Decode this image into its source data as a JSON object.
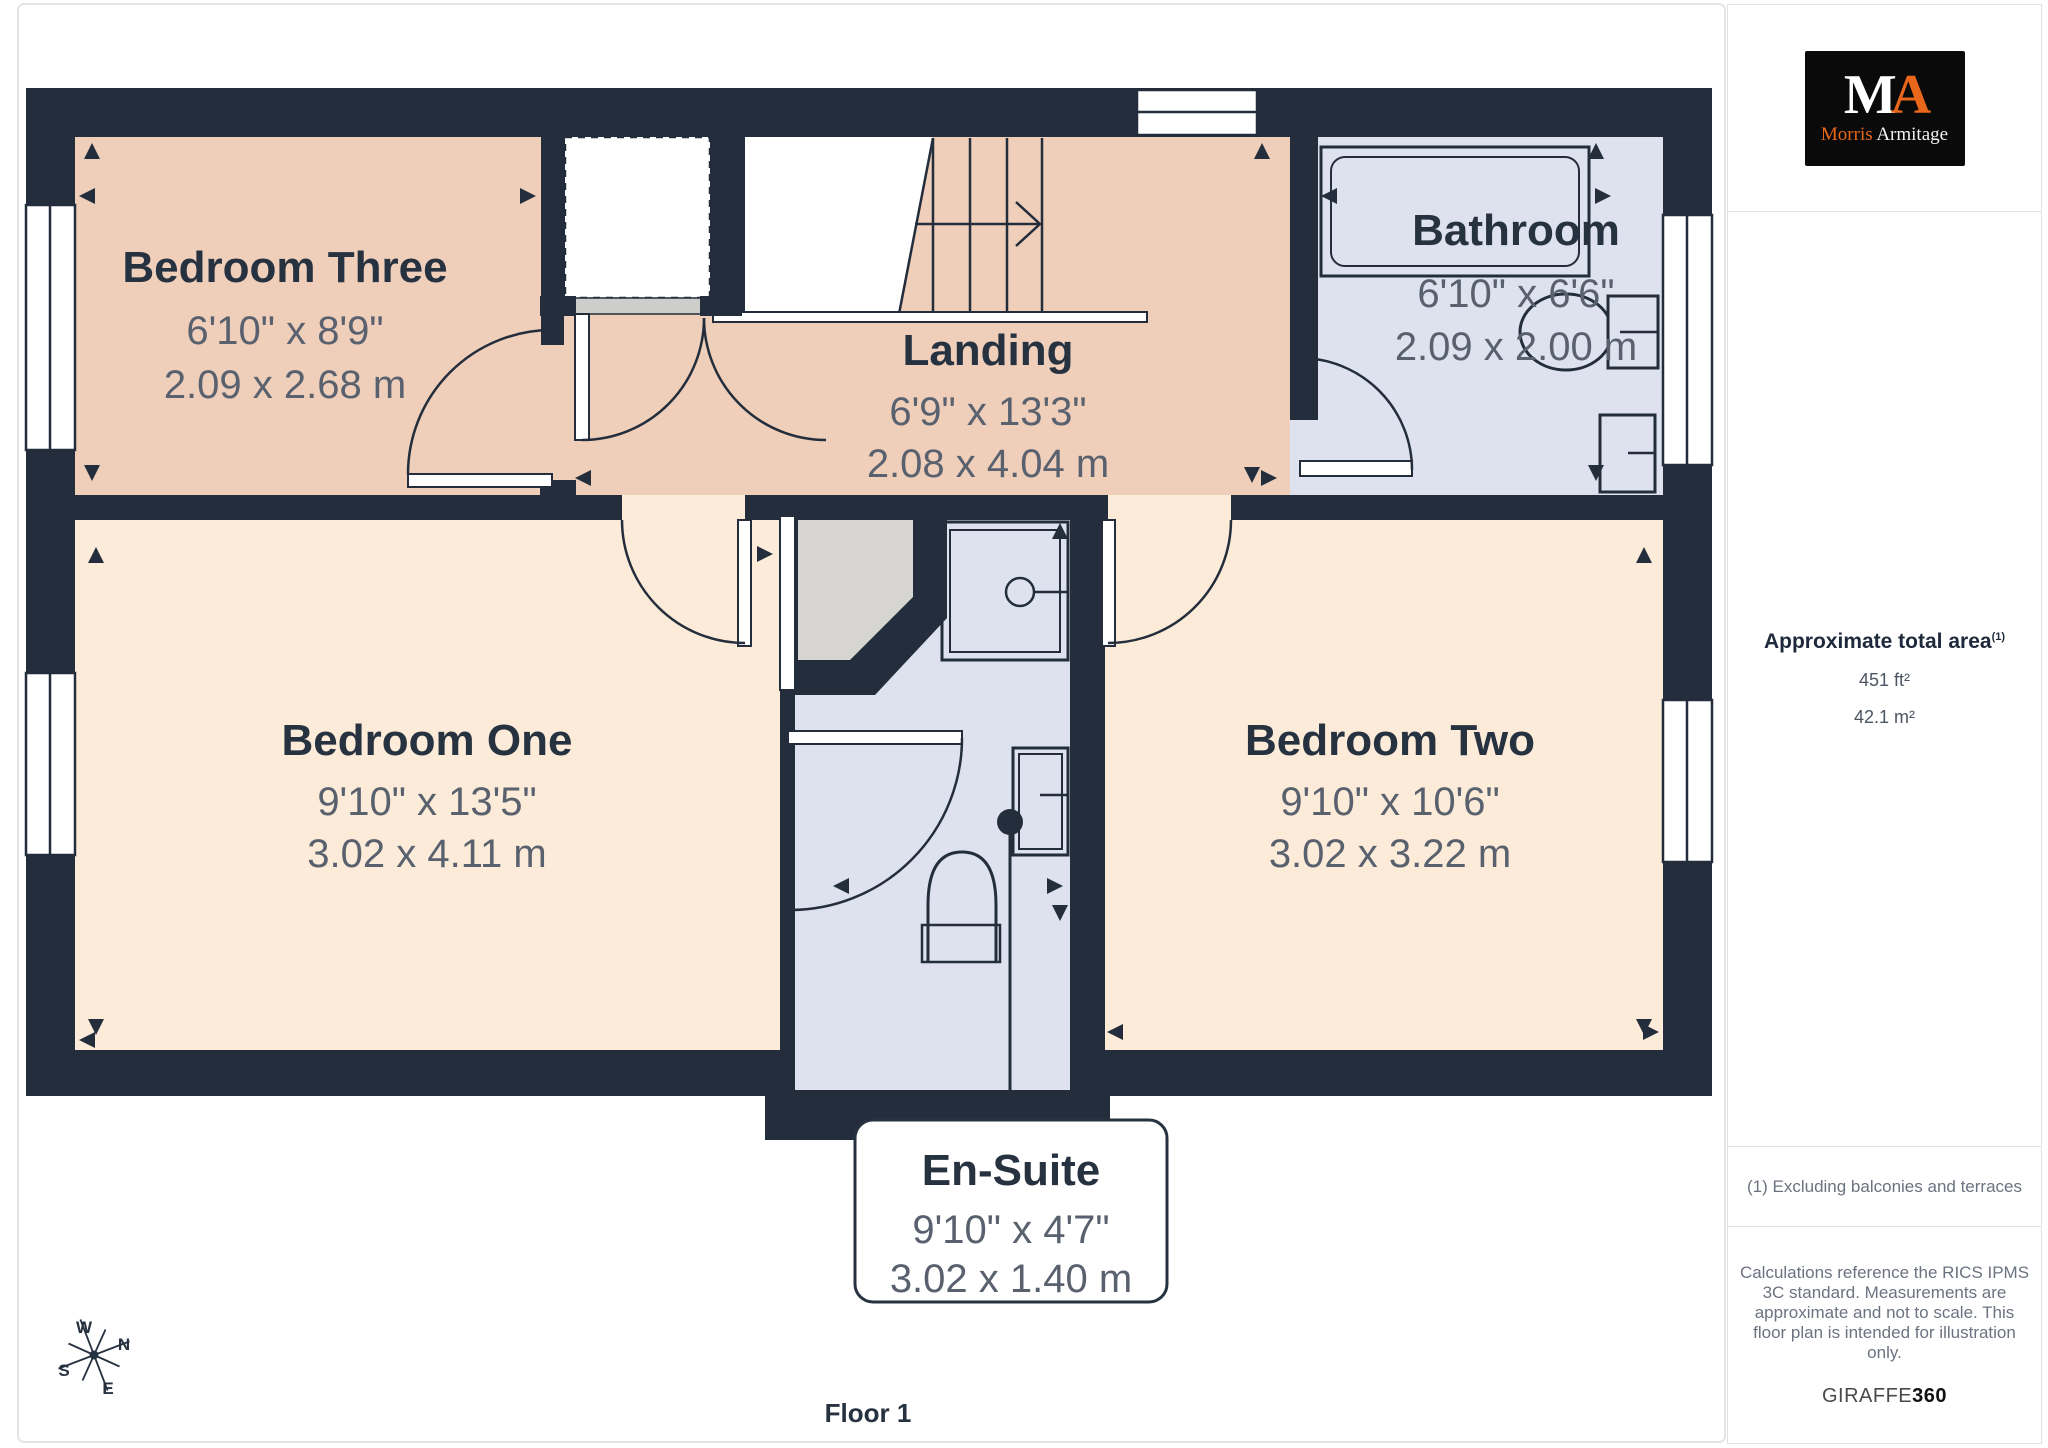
{
  "branding": {
    "logo_m": "M",
    "logo_a": "A",
    "name_first": "Morris",
    "name_second": "Armitage"
  },
  "sidebar": {
    "area_title": "Approximate total area",
    "area_title_sup": "(1)",
    "area_imperial": "451 ft²",
    "area_metric": "42.1 m²",
    "footnote": "(1) Excluding balconies and terraces",
    "disclaimer": "Calculations reference the RICS IPMS 3C standard. Measurements are approximate and not to scale. This floor plan is intended for illustration only.",
    "brand_name": "GIRAFFE",
    "brand_number": "360"
  },
  "floor": {
    "label": "Floor 1"
  },
  "compass": {
    "n": "N",
    "w": "W",
    "s": "S",
    "e": "E"
  },
  "rooms": [
    {
      "name": "Bedroom Three",
      "imperial": "6'10\" x 8'9\"",
      "metric": "2.09 x 2.68 m"
    },
    {
      "name": "Landing",
      "imperial": "6'9\" x 13'3\"",
      "metric": "2.08 x 4.04 m"
    },
    {
      "name": "Bathroom",
      "imperial": "6'10\" x 6'6\"",
      "metric": "2.09 x 2.00 m"
    },
    {
      "name": "Bedroom One",
      "imperial": "9'10\" x 13'5\"",
      "metric": "3.02 x 4.11 m"
    },
    {
      "name": "Bedroom Two",
      "imperial": "9'10\" x 10'6\"",
      "metric": "3.02 x 3.22 m"
    },
    {
      "name": "En-Suite",
      "imperial": "9'10\" x 4'7\"",
      "metric": "3.02 x 1.40 m"
    }
  ],
  "colors": {
    "wall": "#232D3B",
    "room_salmon": "#EFCEBA",
    "room_cream": "#FCEBD8",
    "room_blue": "#DDE2EE",
    "closet_gray": "#D6D5D2",
    "accent_orange": "#E9671B"
  }
}
